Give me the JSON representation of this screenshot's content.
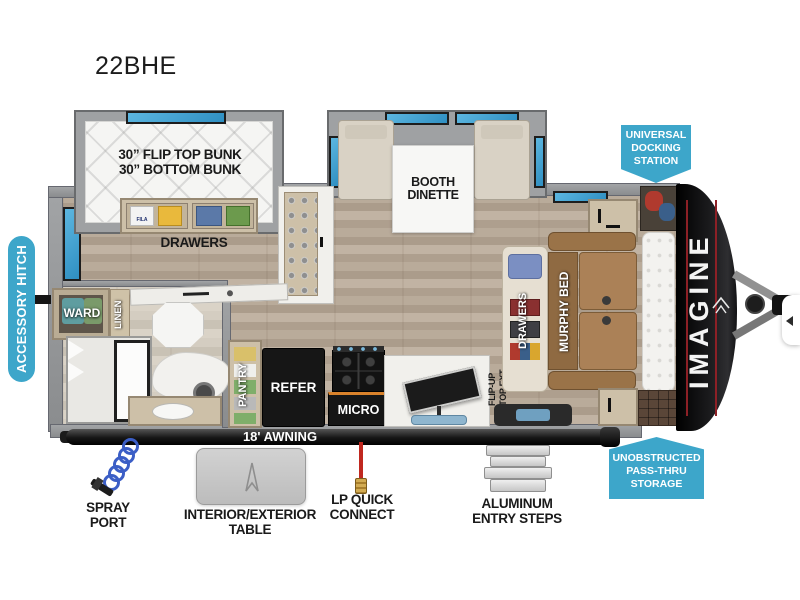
{
  "title": "22BHE",
  "colors": {
    "teal": "#3da6ca",
    "window_blue": "#3f9fd0",
    "cap_black": "#121214",
    "accent_red": "#8d2026"
  },
  "callouts": {
    "accessory_hitch": "ACCESSORY HITCH",
    "docking": {
      "line1": "UNIVERSAL",
      "line2": "DOCKING",
      "line3": "STATION"
    },
    "passthru": {
      "line1": "UNOBSTRUCTED",
      "line2": "PASS-THRU",
      "line3": "STORAGE"
    }
  },
  "interior": {
    "bunk_line1": "30” FLIP TOP BUNK",
    "bunk_line2": "30” BOTTOM BUNK",
    "bunk_drawers": "DRAWERS",
    "shirt_brand": "FILA",
    "booth_line1": "BOOTH",
    "booth_line2": "DINETTE",
    "ward": "WARD",
    "linen": "LINEN",
    "pantry": "PANTRY",
    "refer": "REFER",
    "micro": "MICRO",
    "flip_line1": "FLIP-UP",
    "flip_line2": "CTOP EXT.",
    "bed_drawers": "DRAWERS",
    "murphy_bed": "MURPHY BED",
    "brand": "IMAGINE"
  },
  "exterior": {
    "awning": "18' AWNING",
    "spray_line1": "SPRAY",
    "spray_line2": "PORT",
    "table_label": "INTERIOR/EXTERIOR TABLE",
    "lp_line1": "LP QUICK",
    "lp_line2": "CONNECT",
    "steps_line1": "ALUMINUM",
    "steps_line2": "ENTRY STEPS"
  }
}
